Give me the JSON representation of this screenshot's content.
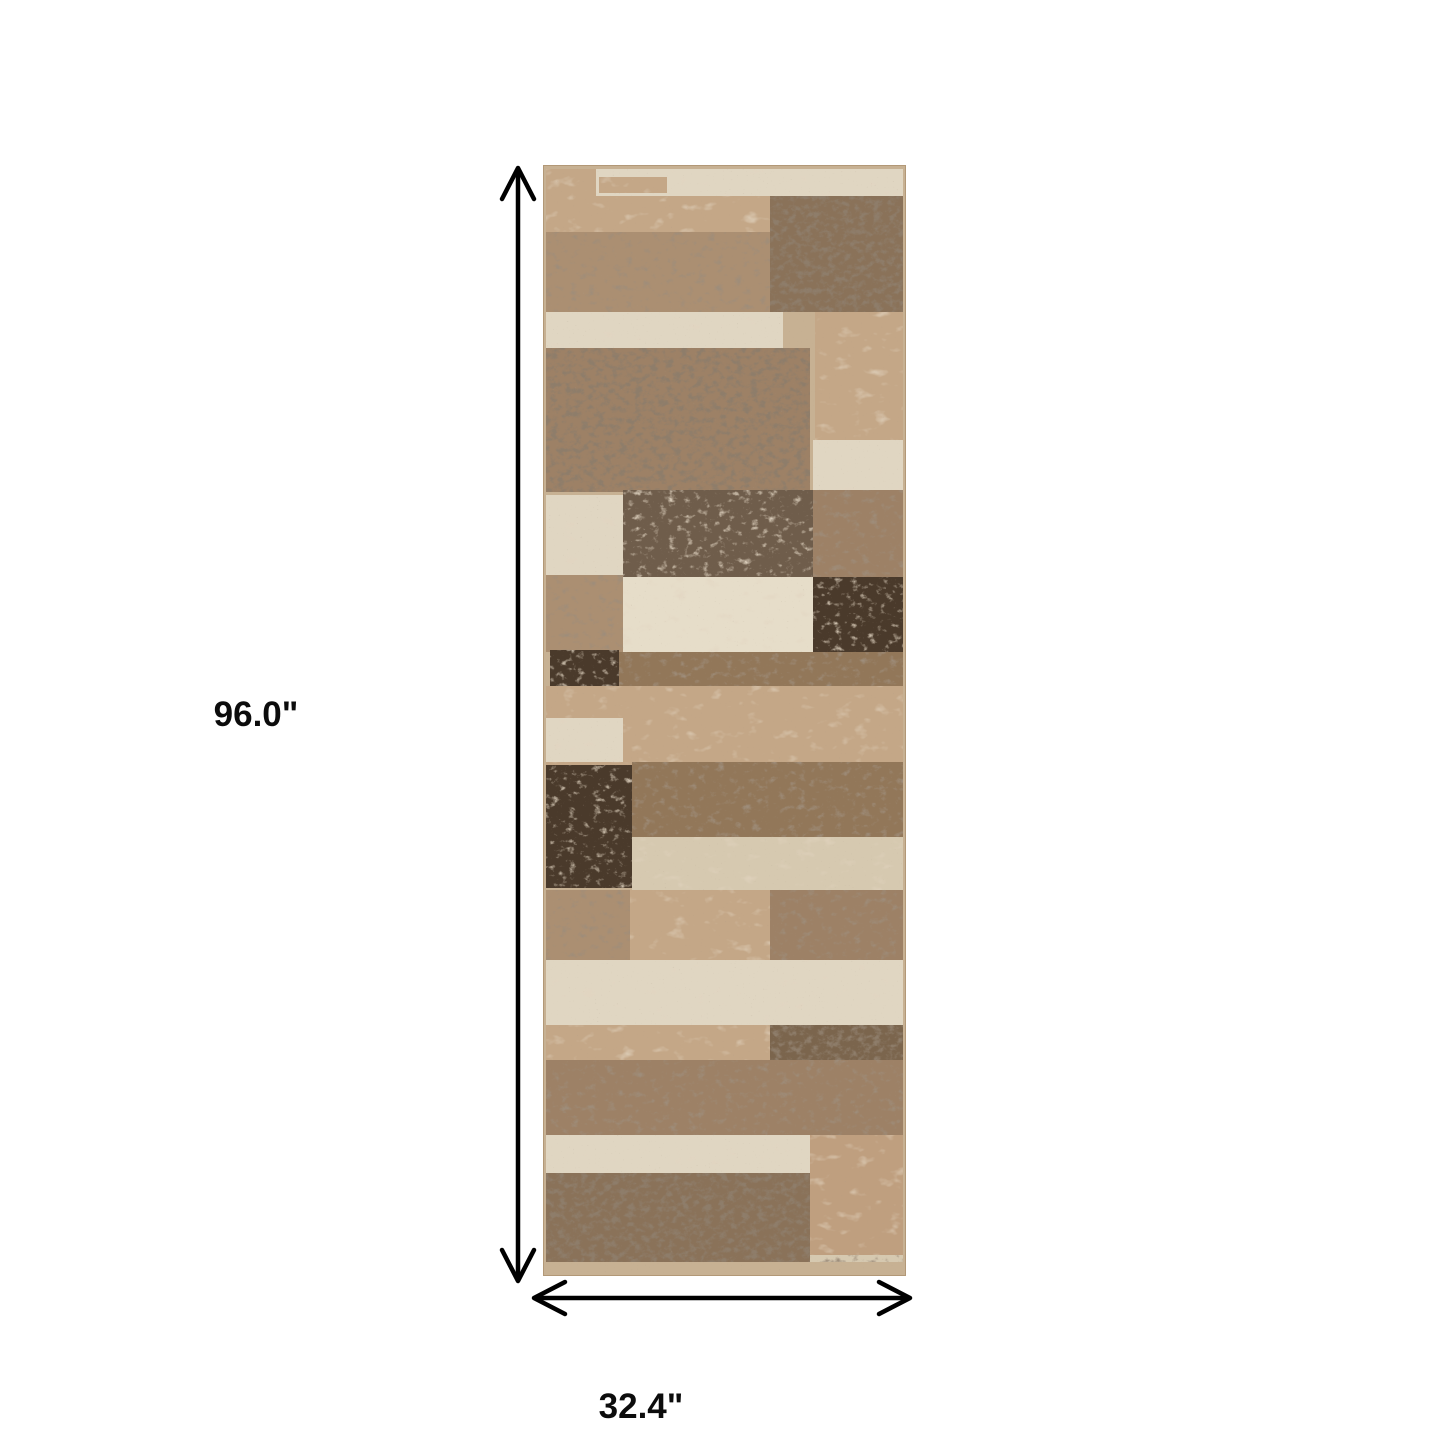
{
  "dimensions": {
    "height_label": "96.0\"",
    "width_label": "32.4\""
  },
  "rug": {
    "palette": {
      "border": "#c7b193",
      "cream": "#e0d6c2",
      "creamBright": "#e6ddc9",
      "tan": "#c4a787",
      "tanDeep": "#bf9f7f",
      "beige": "#d6c9b0",
      "speckLight": "#ab8f72",
      "speck": "#9d8166",
      "speckDeep": "#927759",
      "speckDark": "#8a7259",
      "greyBrown": "#6f5d4b",
      "darkBlock": "#7b654d",
      "chocolate": "#4a3a2b"
    },
    "patches": [
      {
        "x": 3,
        "y": 4,
        "w": 357,
        "h": 28,
        "c": "cream",
        "t": "blotch"
      },
      {
        "x": 3,
        "y": 4,
        "w": 50,
        "h": 28,
        "c": "tan",
        "t": "blotch"
      },
      {
        "x": 56,
        "y": 12,
        "w": 68,
        "h": 16,
        "c": "tan",
        "t": "blotch"
      },
      {
        "x": 3,
        "y": 31,
        "w": 224,
        "h": 41,
        "c": "tan",
        "t": "blotch"
      },
      {
        "x": 3,
        "y": 67,
        "w": 357,
        "h": 80,
        "c": "speckLight",
        "t": "dark"
      },
      {
        "x": 227,
        "y": 31,
        "w": 133,
        "h": 116,
        "c": "speckDark",
        "t": "strong"
      },
      {
        "x": 3,
        "y": 147,
        "w": 237,
        "h": 38,
        "c": "cream",
        "t": "blotch"
      },
      {
        "x": 272,
        "y": 147,
        "w": 88,
        "h": 128,
        "c": "tan",
        "t": "blotch"
      },
      {
        "x": 3,
        "y": 183,
        "w": 264,
        "h": 144,
        "c": "speck",
        "t": "strong"
      },
      {
        "x": 270,
        "y": 275,
        "w": 90,
        "h": 52,
        "c": "cream",
        "t": "blotch"
      },
      {
        "x": 80,
        "y": 325,
        "w": 190,
        "h": 87,
        "c": "greyBrown",
        "t": "light"
      },
      {
        "x": 270,
        "y": 325,
        "w": 90,
        "h": 87,
        "c": "speck",
        "t": "dark"
      },
      {
        "x": 3,
        "y": 330,
        "w": 77,
        "h": 82,
        "c": "cream",
        "t": "blotch"
      },
      {
        "x": 3,
        "y": 410,
        "w": 77,
        "h": 77,
        "c": "speckLight",
        "t": "dark"
      },
      {
        "x": 80,
        "y": 412,
        "w": 190,
        "h": 75,
        "c": "creamBright",
        "t": "blotch"
      },
      {
        "x": 270,
        "y": 412,
        "w": 90,
        "h": 75,
        "c": "chocolate",
        "t": "light"
      },
      {
        "x": 7,
        "y": 485,
        "w": 69,
        "h": 36,
        "c": "chocolate",
        "t": "light"
      },
      {
        "x": 76,
        "y": 487,
        "w": 284,
        "h": 38,
        "c": "speckDeep",
        "t": "dark"
      },
      {
        "x": 3,
        "y": 521,
        "w": 357,
        "h": 79,
        "c": "tan",
        "t": "blotch"
      },
      {
        "x": 3,
        "y": 553,
        "w": 77,
        "h": 44,
        "c": "cream",
        "t": "blotch"
      },
      {
        "x": 89,
        "y": 597,
        "w": 271,
        "h": 75,
        "c": "speckDeep",
        "t": "dark"
      },
      {
        "x": 3,
        "y": 600,
        "w": 86,
        "h": 123,
        "c": "chocolate",
        "t": "light"
      },
      {
        "x": 89,
        "y": 672,
        "w": 271,
        "h": 53,
        "c": "beige",
        "t": "blotch"
      },
      {
        "x": 3,
        "y": 725,
        "w": 84,
        "h": 70,
        "c": "speckLight",
        "t": "dark"
      },
      {
        "x": 87,
        "y": 725,
        "w": 140,
        "h": 70,
        "c": "tan",
        "t": "blotch"
      },
      {
        "x": 227,
        "y": 725,
        "w": 133,
        "h": 70,
        "c": "speck",
        "t": "dark"
      },
      {
        "x": 3,
        "y": 795,
        "w": 357,
        "h": 65,
        "c": "cream",
        "t": "blotch"
      },
      {
        "x": 3,
        "y": 860,
        "w": 224,
        "h": 38,
        "c": "tan",
        "t": "blotch"
      },
      {
        "x": 227,
        "y": 860,
        "w": 133,
        "h": 40,
        "c": "darkBlock",
        "t": "strong"
      },
      {
        "x": 3,
        "y": 895,
        "w": 357,
        "h": 75,
        "c": "speck",
        "t": "dark"
      },
      {
        "x": 3,
        "y": 970,
        "w": 264,
        "h": 38,
        "c": "cream",
        "t": "blotch"
      },
      {
        "x": 267,
        "y": 970,
        "w": 93,
        "h": 123,
        "c": "tanDeep",
        "t": "blotch"
      },
      {
        "x": 3,
        "y": 1008,
        "w": 264,
        "h": 89,
        "c": "speckDark",
        "t": "strong"
      },
      {
        "x": 267,
        "y": 1090,
        "w": 93,
        "h": 17,
        "c": "beige",
        "t": "dark"
      },
      {
        "x": 3,
        "y": 1097,
        "w": 357,
        "h": 11,
        "c": "border",
        "t": "none"
      }
    ]
  }
}
